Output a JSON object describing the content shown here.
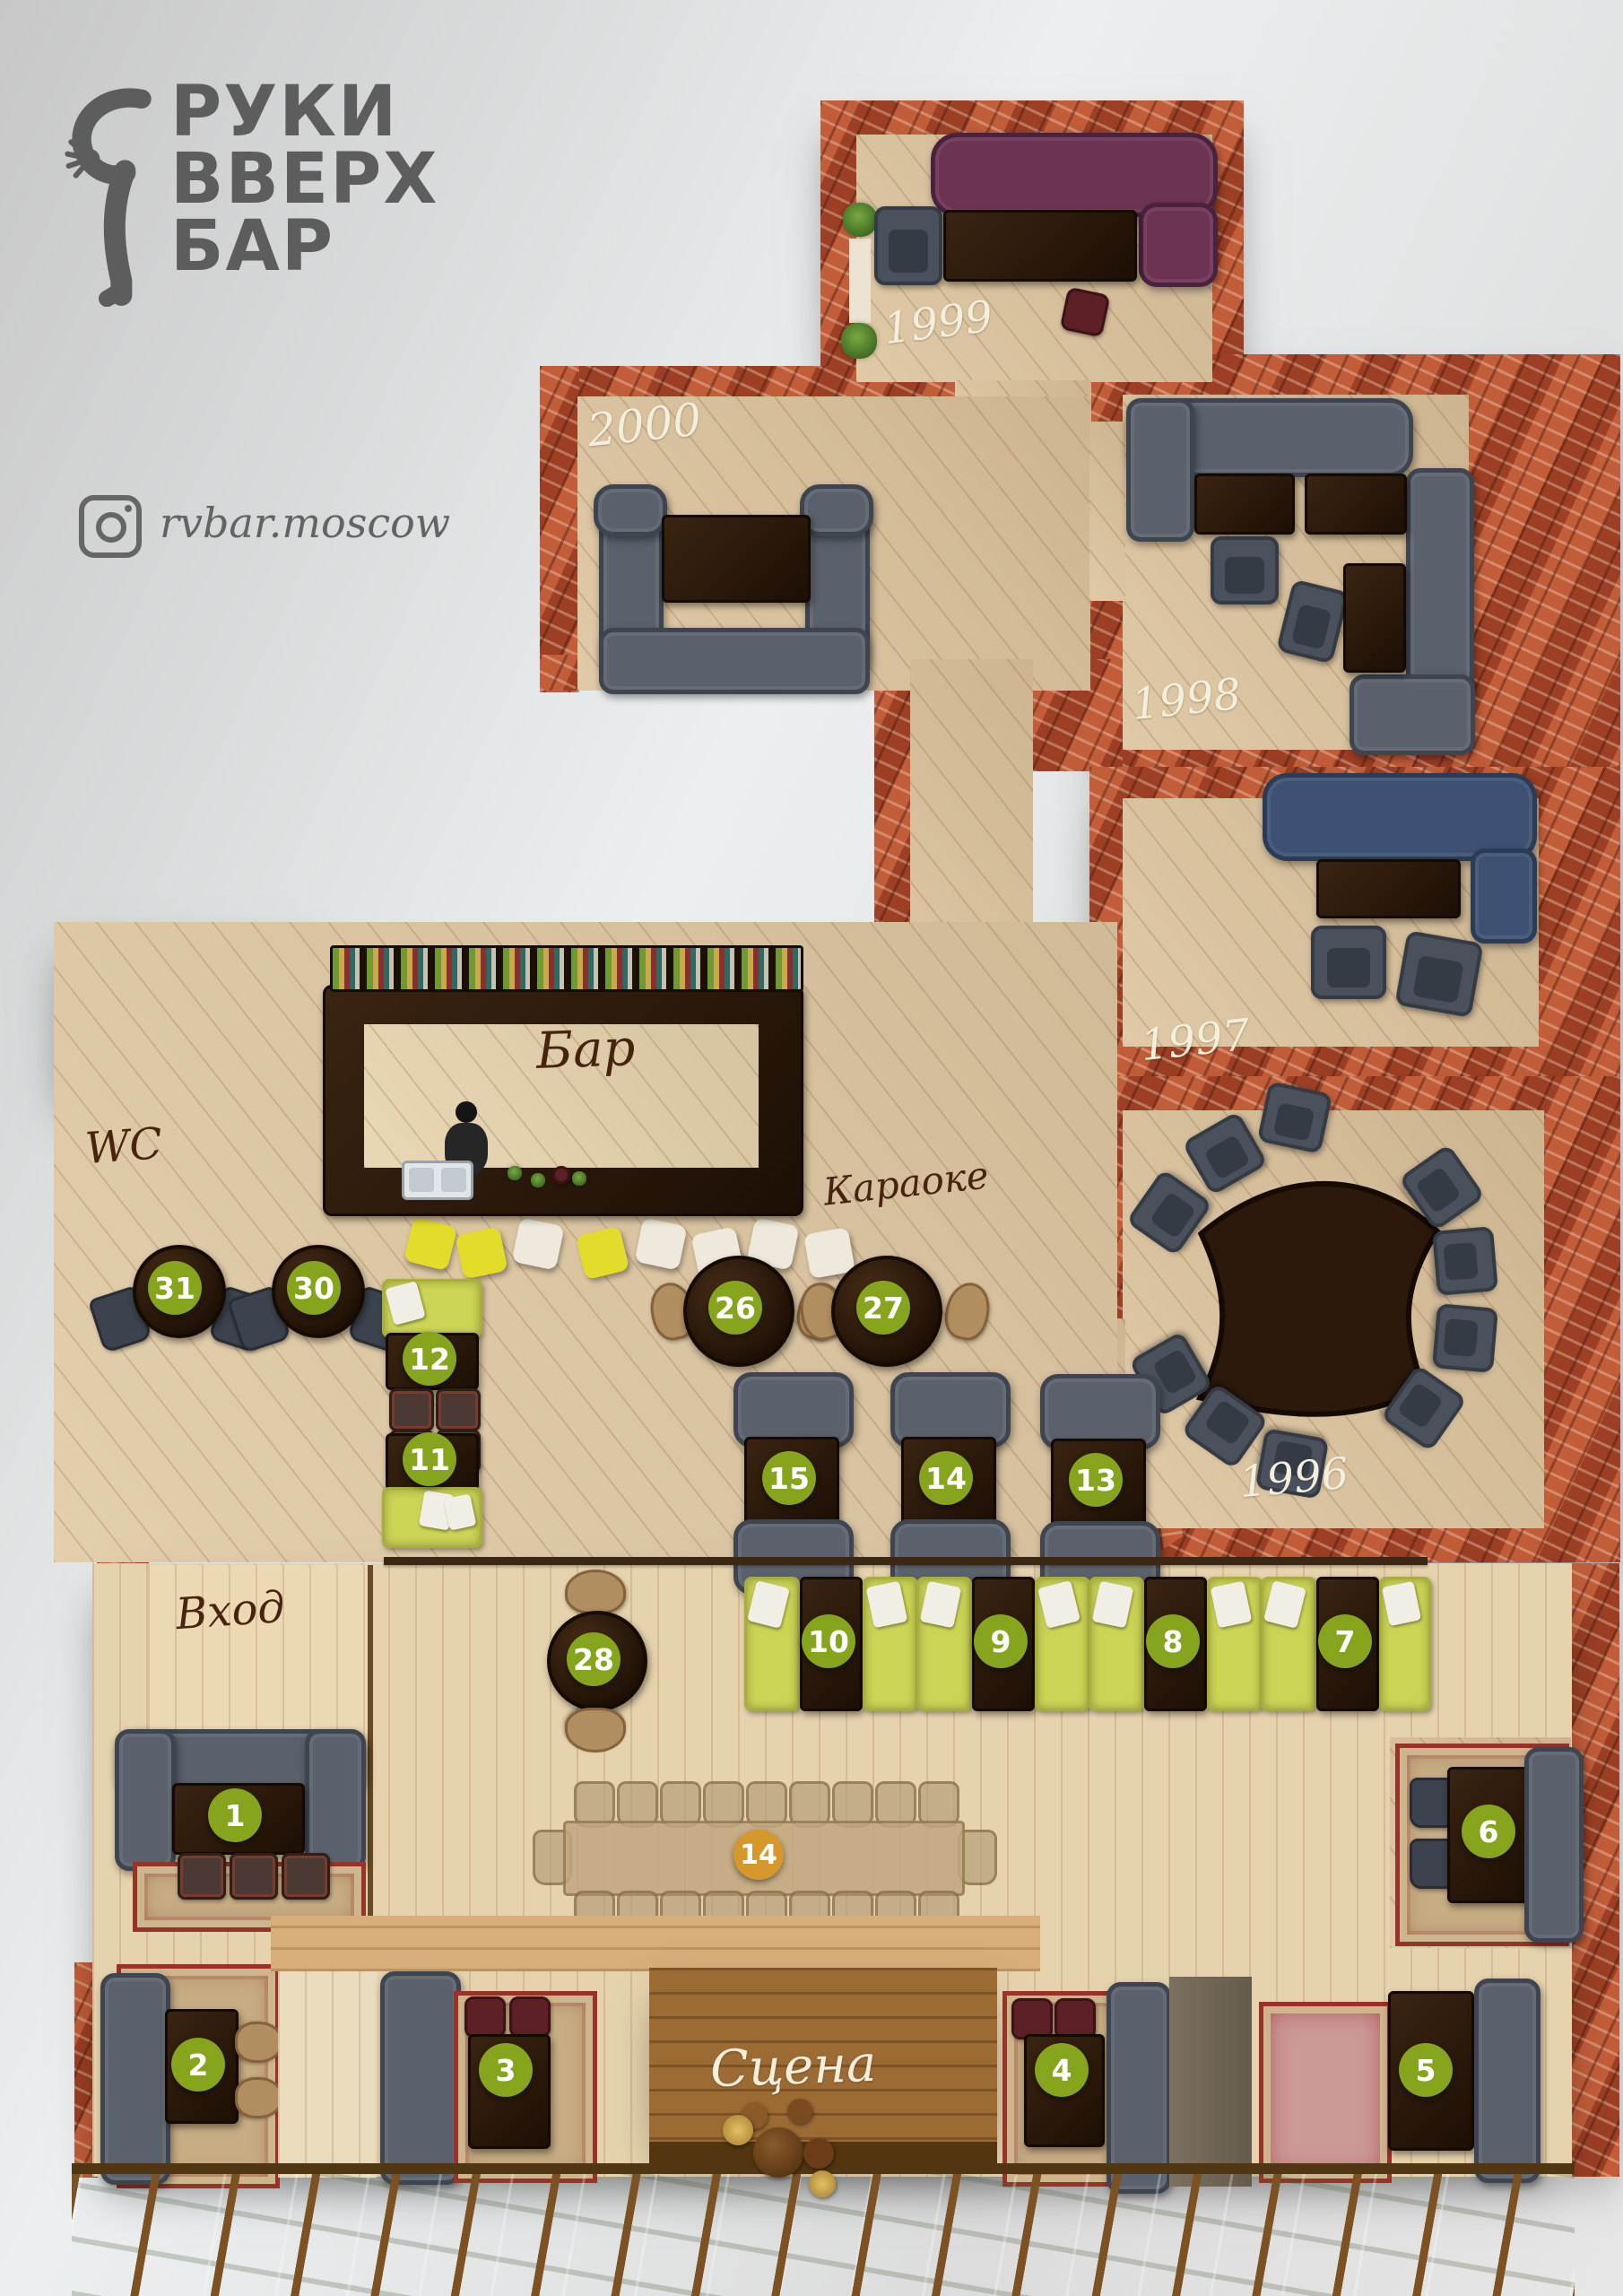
{
  "brand": {
    "line1": "РУКИ",
    "line2": "ВВЕРХ",
    "line3": "БАР",
    "instagram": "rvbar.moscow"
  },
  "areas": {
    "wc": "WC",
    "bar": "Бар",
    "karaoke": "Караоке",
    "entrance": "Вход",
    "stage": "Сцена"
  },
  "rooms": {
    "y1999": "1999",
    "y2000": "2000",
    "y1998": "1998",
    "y1997": "1997",
    "y1996": "1996"
  },
  "tables": {
    "t1": "1",
    "t2": "2",
    "t3": "3",
    "t4": "4",
    "t5": "5",
    "t6": "6",
    "t7": "7",
    "t8": "8",
    "t9": "9",
    "t10": "10",
    "t11": "11",
    "t12": "12",
    "t13": "13",
    "t14": "14",
    "t15": "15",
    "t26": "26",
    "t27": "27",
    "t28": "28",
    "t30": "30",
    "t31": "31",
    "t14big": "14"
  },
  "colors": {
    "badge_green": "#86a41c",
    "badge_orange": "#d6982a",
    "lime_sofa": "#ccd455",
    "gray_sofa": "#5a616c",
    "purple_sofa": "#6d3353",
    "blue_sofa": "#3d5272",
    "brick": "#a8492b",
    "wood_light": "#dcc29b",
    "stage_wood": "#9c6b33",
    "table_dark": "#2c190c"
  }
}
